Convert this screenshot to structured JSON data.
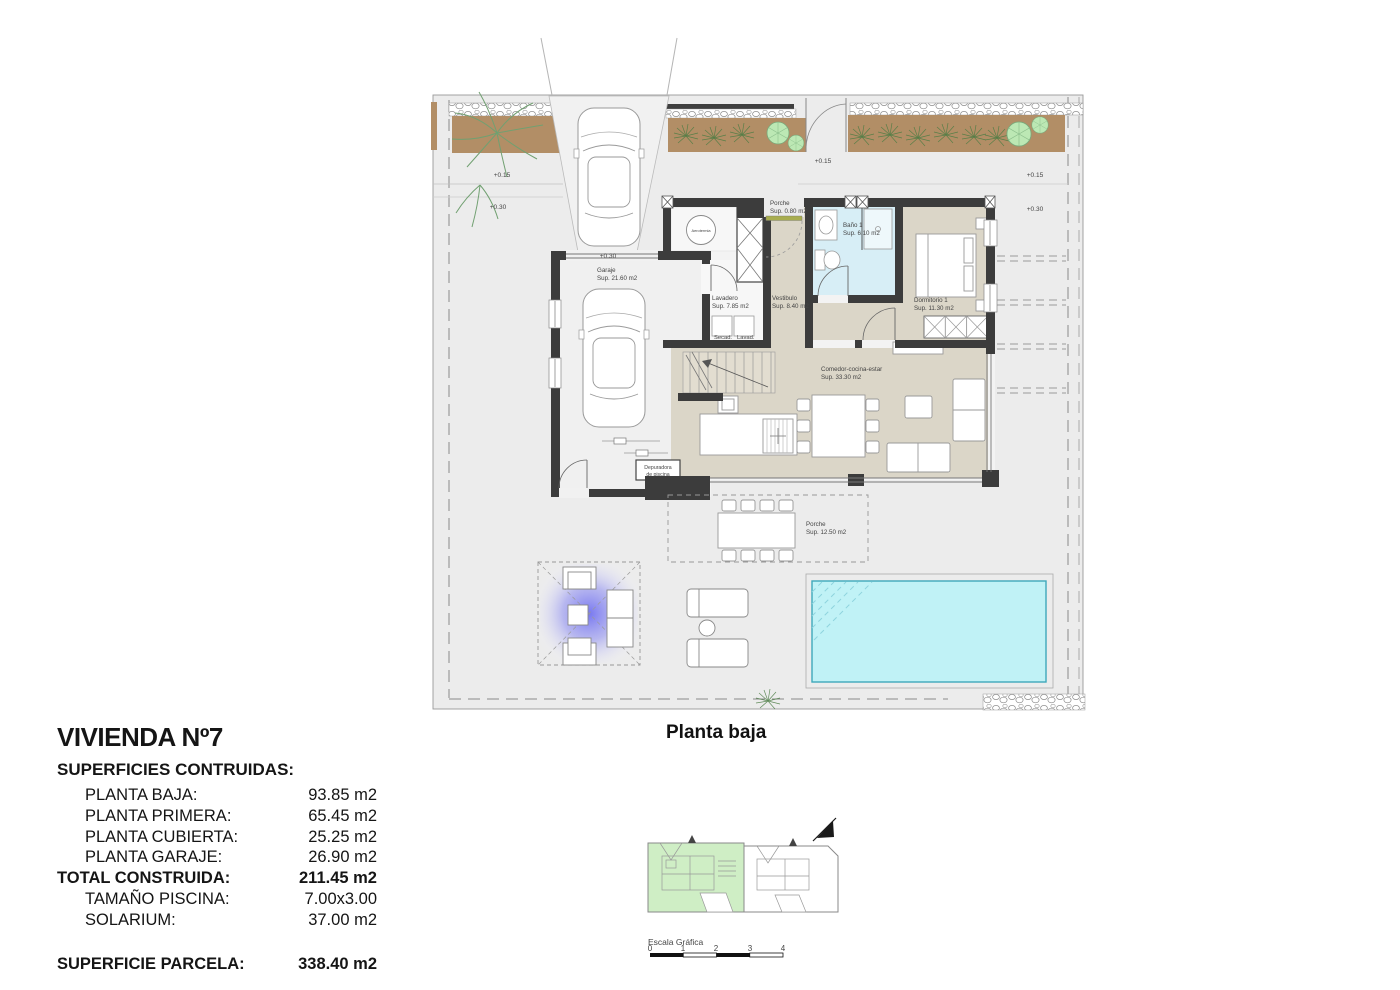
{
  "document": {
    "plan_title": "Planta baja"
  },
  "summary": {
    "title": "VIVIENDA Nº7",
    "heading": "SUPERFICIES CONTRUIDAS:",
    "rows": [
      {
        "label": "PLANTA BAJA:",
        "value": "93.85 m2"
      },
      {
        "label": "PLANTA PRIMERA:",
        "value": "65.45 m2"
      },
      {
        "label": "PLANTA CUBIERTA:",
        "value": "25.25 m2"
      },
      {
        "label": "PLANTA GARAJE:",
        "value": "26.90 m2"
      }
    ],
    "total": {
      "label": "TOTAL CONSTRUIDA:",
      "value": "211.45 m2"
    },
    "extras": [
      {
        "label": "TAMAÑO PISCINA:",
        "value": "7.00x3.00"
      },
      {
        "label": "SOLARIUM:",
        "value": "37.00 m2"
      }
    ],
    "parcel": {
      "label": "SUPERFICIE PARCELA:",
      "value": "338.40 m2"
    }
  },
  "plan": {
    "rooms": {
      "garaje": {
        "name": "Garaje",
        "sup": "Sup. 21.60 m2"
      },
      "lavadero": {
        "name": "Lavadero",
        "sup": "Sup. 7.85 m2"
      },
      "vestibulo": {
        "name": "Vestibulo",
        "sup": "Sup. 8.40 m2"
      },
      "porche_entrada": {
        "name": "Porche",
        "sup": "Sup. 0.80 m2"
      },
      "bano1": {
        "name": "Baño 1",
        "sup": "Sup. 6.10 m2"
      },
      "dormitorio1": {
        "name": "Dormitorio 1",
        "sup": "Sup. 11.30 m2"
      },
      "comedor": {
        "name": "Comedor-cocina-estar",
        "sup": "Sup. 33.30 m2"
      },
      "porche": {
        "name": "Porche",
        "sup": "Sup. 12.50 m2"
      }
    },
    "labels": {
      "secad": "Secad.",
      "lavad": "Lavad.",
      "aerotermia": "Aerotermia",
      "depuradora_1": "Depuradora",
      "depuradora_2": "de piscina"
    },
    "levels": {
      "p015": "+0.15",
      "p030": "+0.30"
    }
  },
  "key_plan": {
    "scale_label": "Escala Gráfica",
    "ticks": [
      "0",
      "1",
      "2",
      "3",
      "4"
    ]
  },
  "colors": {
    "wall": "#3c3c3c",
    "floor": "#dbd6c8",
    "bath": "#d7eef6",
    "pool": "#c0f2f6",
    "pool_border": "#3fa9bb",
    "planting": "#b28e66",
    "tree": "#bce8b4",
    "pergola": "#7d7deb",
    "keyplan_house": "#cfeec5",
    "plot": "#ececec",
    "entry_door": "#a8ad4f"
  }
}
